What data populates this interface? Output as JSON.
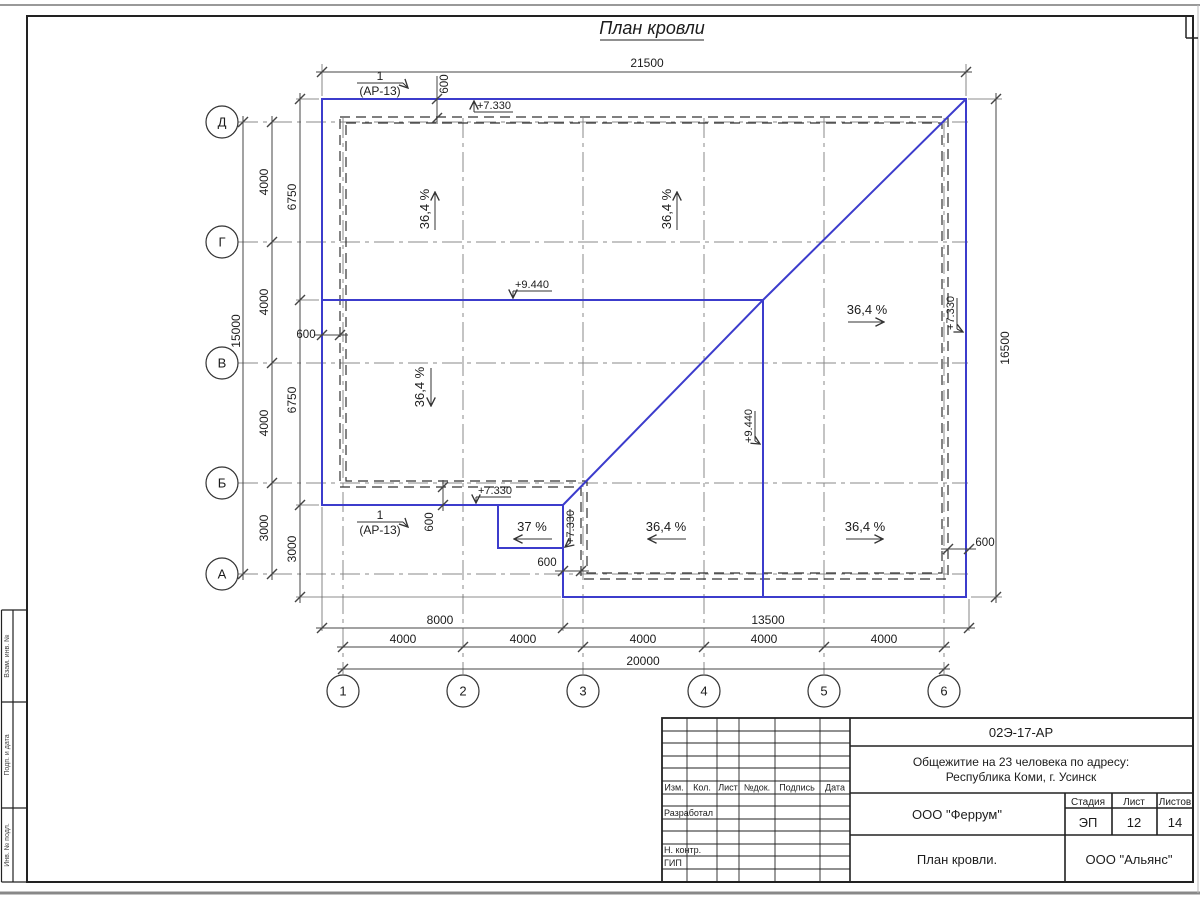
{
  "drawing": {
    "title": "План кровли",
    "callout": {
      "number": "1",
      "sheet_ref": "(АР-13)"
    },
    "slopes": {
      "main": "36,4 %",
      "canopy": "37 %"
    },
    "levels": {
      "eaves": "+7.330",
      "upper": "+9.440"
    }
  },
  "dimensions": {
    "top_total": "21500",
    "right_height": "16500",
    "left_total": "15000",
    "left_axis_steps": [
      "4000",
      "4000",
      "4000",
      "3000"
    ],
    "left_inner": [
      "6750",
      "6750",
      "3000"
    ],
    "overhang": "600",
    "bottom_spans": [
      "8000",
      "13500"
    ],
    "bottom_axis_steps": [
      "4000",
      "4000",
      "4000",
      "4000",
      "4000"
    ],
    "bottom_total": "20000"
  },
  "axes": {
    "rows": [
      "Д",
      "Г",
      "В",
      "Б",
      "А"
    ],
    "cols": [
      "1",
      "2",
      "3",
      "4",
      "5",
      "6"
    ]
  },
  "margin_labels": [
    "Взам. инв. №",
    "Подп. и дата",
    "Инв. № подл."
  ],
  "title_block": {
    "doc_code": "02Э-17-АР",
    "project_line1": "Общежитие на 23 человека по адресу:",
    "project_line2": "Республика Коми, г. Усинск",
    "columns": [
      "Изм.",
      "Кол.",
      "Лист",
      "№док.",
      "Подпись",
      "Дата"
    ],
    "roles": [
      "Разработал",
      "Н. контр.",
      "ГИП"
    ],
    "org_design": "ООО \"Феррум\"",
    "stage_label": "Стадия",
    "sheet_label": "Лист",
    "sheets_label": "Листов",
    "stage_value": "ЭП",
    "sheet_value": "12",
    "sheets_value": "14",
    "drawing_title": "План кровли.",
    "org_customer": "ООО \"Альянс\""
  }
}
